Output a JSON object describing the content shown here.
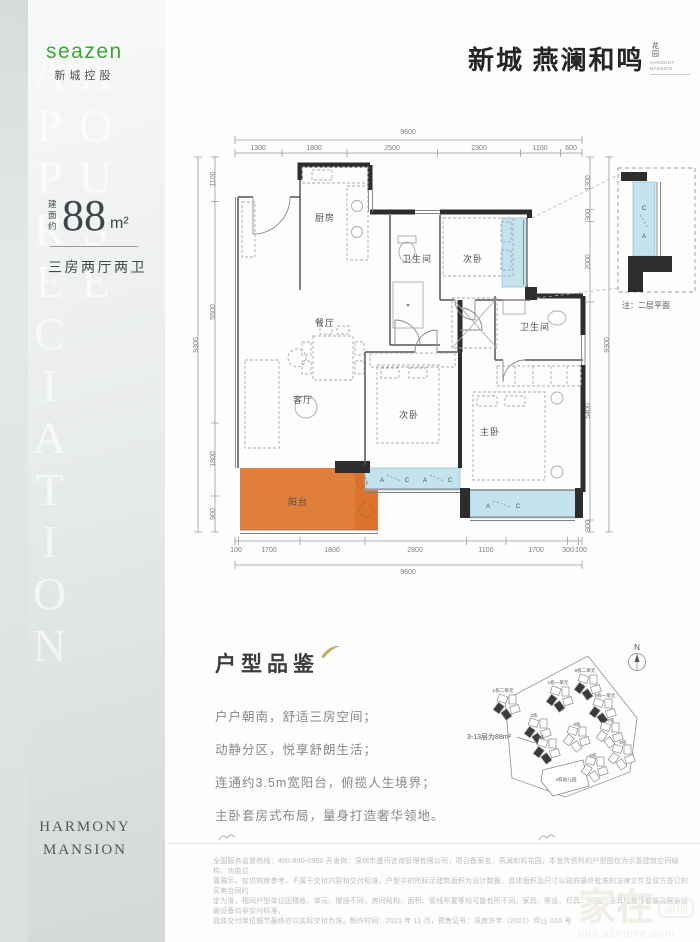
{
  "brand": {
    "name": "seazen",
    "sub": "新城控股"
  },
  "header": {
    "title": "新城 燕澜和鸣",
    "title_side": "花园",
    "title_side_en": "HARMONY MANSION"
  },
  "sidebar": {
    "watermark": "HOUSE APPRECIATION",
    "footer1": "HARMONY",
    "footer2": "MANSION"
  },
  "unit": {
    "prefix": "建面约",
    "area": "88",
    "area_unit": "m²",
    "layout": "三房两厅两卫"
  },
  "floorplan": {
    "rooms": {
      "kitchen": "厨房",
      "dining": "餐厅",
      "living": "客厅",
      "bath1": "卫生间",
      "bed2": "次卧",
      "bed3": "次卧",
      "master": "主卧",
      "bath2": "卫生间",
      "balcony": "阳台"
    },
    "dims": {
      "top_total": "9600",
      "top": [
        "1300",
        "1800",
        "2500",
        "2300",
        "1100",
        "600"
      ],
      "left_total": "9300",
      "left": [
        "1100",
        "5500",
        "1800",
        "900"
      ],
      "right": [
        "1300",
        "300",
        "2000",
        "5400",
        "300"
      ],
      "right_total": "9300",
      "bottom": [
        "100",
        "1700",
        "1800",
        "2800",
        "1100",
        "1700",
        "300",
        "100"
      ],
      "bottom_total": "9600"
    },
    "ac": {
      "a": "A",
      "c": "C"
    },
    "inset_note": "注：二层平面"
  },
  "appreciation": {
    "title": "户型品鉴",
    "lines": [
      "户户朝南，舒适三房空间；",
      "动静分区，悦享舒朗生活；",
      "连通约3.5m宽阳台，俯揽人生境界；",
      "主卧套房式布局，量身打造奢华领地。"
    ]
  },
  "siteplan": {
    "compass": "N",
    "callout": "3-13层为88m²",
    "buildings": [
      "1栋二单元",
      "1栋一单元",
      "9栋二单元",
      "9栋一单元",
      "2栋",
      "3栋",
      "8栋",
      "7栋",
      "6栋",
      "5栋",
      "4栋幼儿园"
    ]
  },
  "legal": {
    "lines": [
      "全国服务监督热线：400-890-0950 开发商：深圳市盛讯咨询管理有限公司，项目备案名：燕澜和鸣花园，本宣传资料的户型图仅为示意建筑空间结构，功能位",
      "置展示，仅供购房参考，不属于交付内容和交付标准，户型中的所标示建筑面积为设计数据，具体面积及尺寸以政府最终批准的法律文件及双方签订的买卖合同约",
      "定为准，相同户型单位因楼栋、单元、楼层不同，房间结构、面积、管线布置等均可能有所不同，家具、陈设、灯具、家电、洁具摆放等软装及硬装设施设备均非交付标准，",
      "具体交付单位细节最终应以实际交付为准。制作时间：2021 年 11 月，预售证号：深房许字（2021）坪山 010 号"
    ]
  },
  "watermark": {
    "main": "家在",
    "badge": "深圳",
    "url": "bbs.szhome.com"
  }
}
